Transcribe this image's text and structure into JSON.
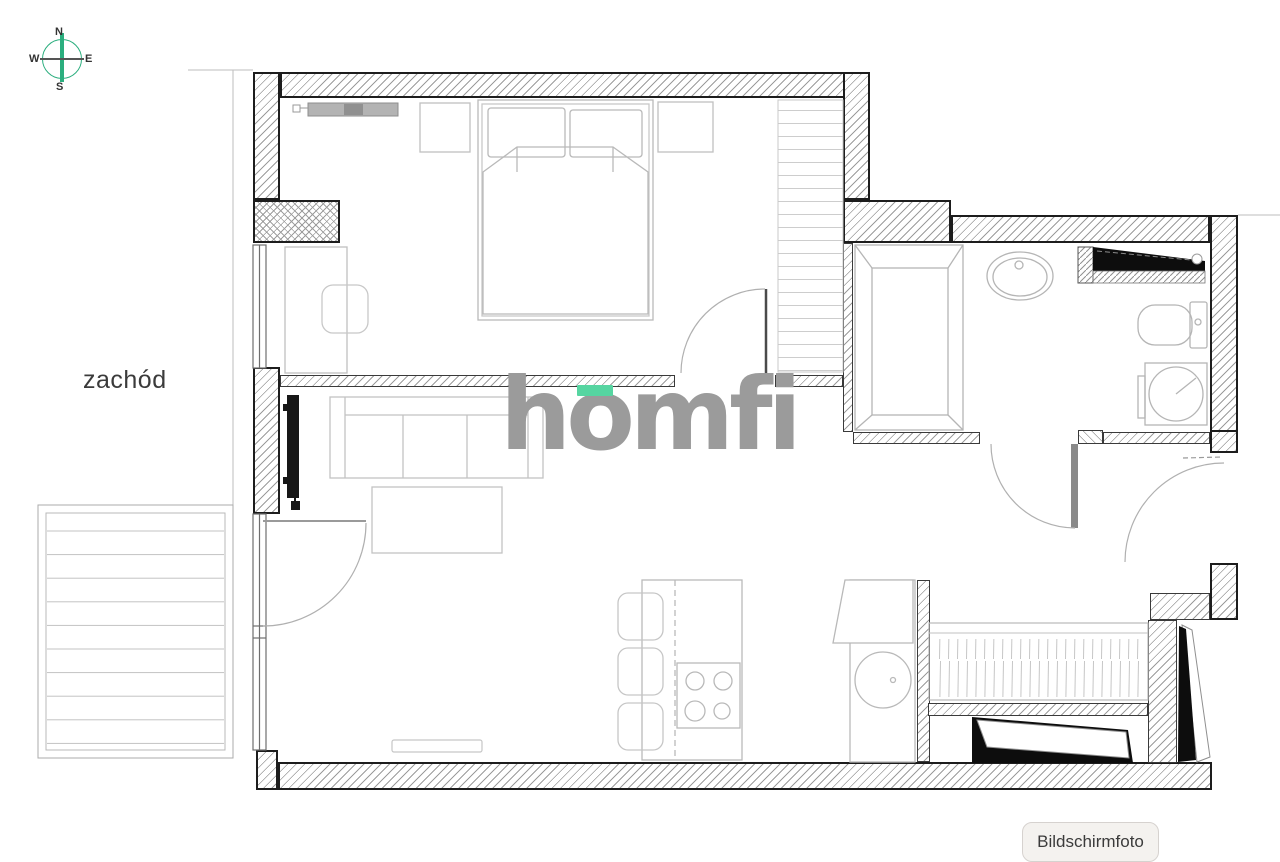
{
  "compass": {
    "n": "N",
    "e": "E",
    "s": "S",
    "w": "W"
  },
  "labels": {
    "west": "zachód"
  },
  "watermark": {
    "text": "homfi"
  },
  "tooltip": {
    "text": "Bildschirmfoto"
  },
  "colors": {
    "compass_green": "#2bae7e",
    "logo_gray": "#9b9b9b",
    "logo_accent_green": "#56d5a1",
    "wall_outline": "#1d1d1d",
    "hatch_gray": "#9c9c9c",
    "furniture_gray": "#b9b9b9",
    "black_fixture": "#0d0d0d",
    "tooltip_bg": "#f4f2ef",
    "tooltip_border": "#d6d2cf",
    "label_text": "#3b3b3b"
  },
  "plan": {
    "type": "apartment-floor-plan",
    "fixtures": [
      "bed",
      "pillows",
      "nightstands",
      "wardrobe",
      "radiator",
      "desk",
      "chair",
      "tv",
      "sofa",
      "coffee-table",
      "balcony",
      "kitchen-counter",
      "stove",
      "dining-chairs",
      "kitchen-sink",
      "shower",
      "bathroom-sink",
      "toilet",
      "washing-machine",
      "hall-wardrobe",
      "entrance-door"
    ]
  }
}
